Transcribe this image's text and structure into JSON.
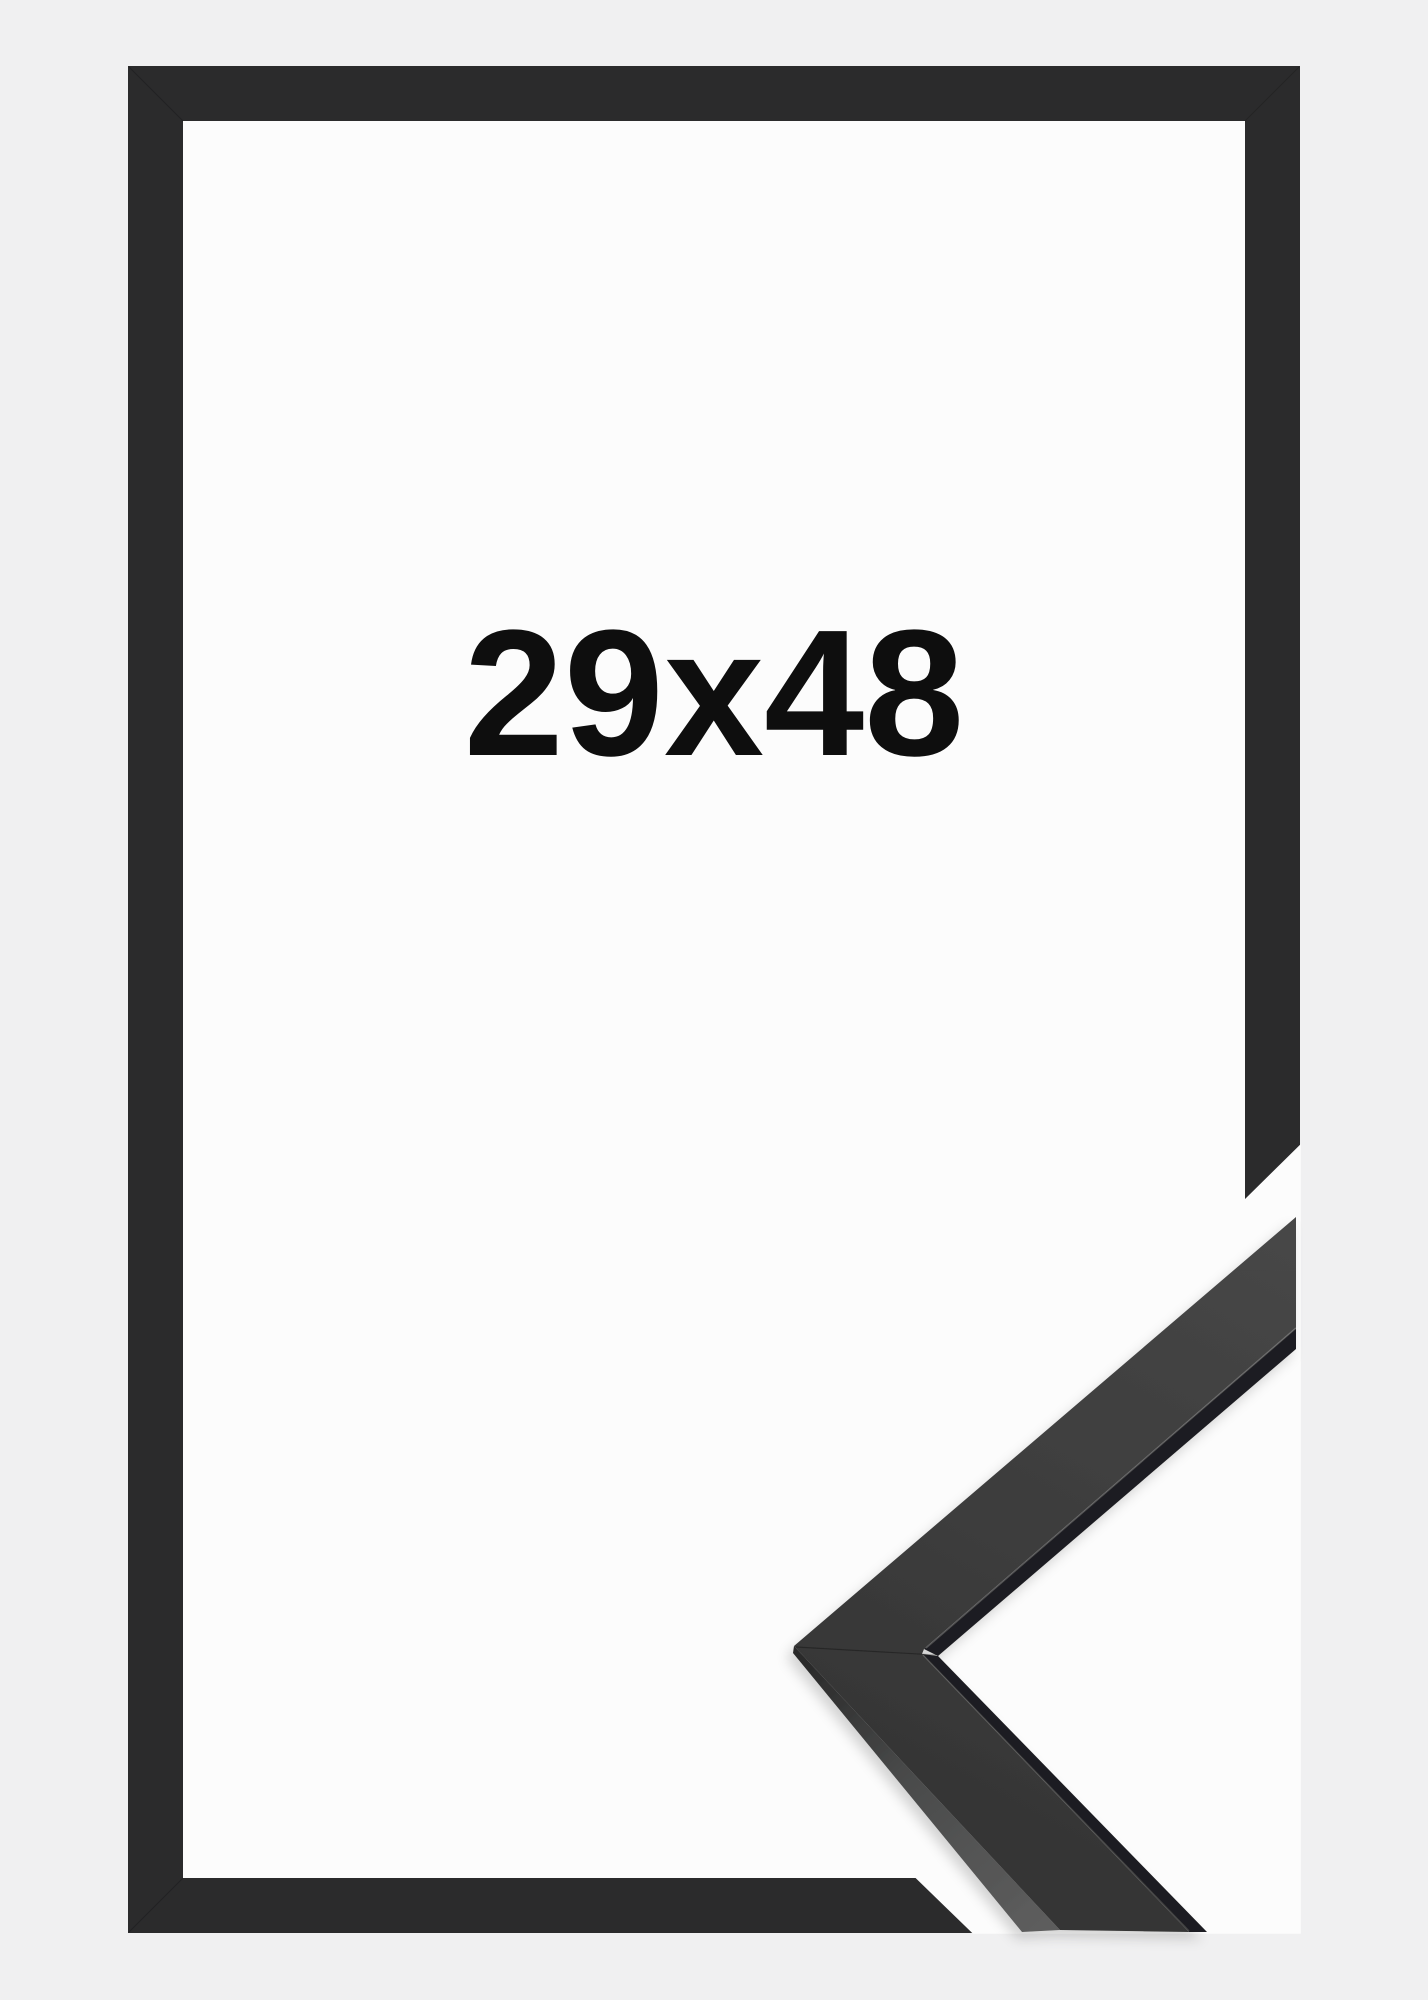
{
  "product": {
    "size_label": "29x48"
  },
  "colors": {
    "background": "#f0f0f1",
    "backing": "#fcfcfc",
    "frame": "#2b2b2c",
    "label": "#0e0e0e",
    "moulding_face": "#3d3d3d",
    "moulding_edge": "#1f1f20",
    "moulding_side": "#565656"
  }
}
